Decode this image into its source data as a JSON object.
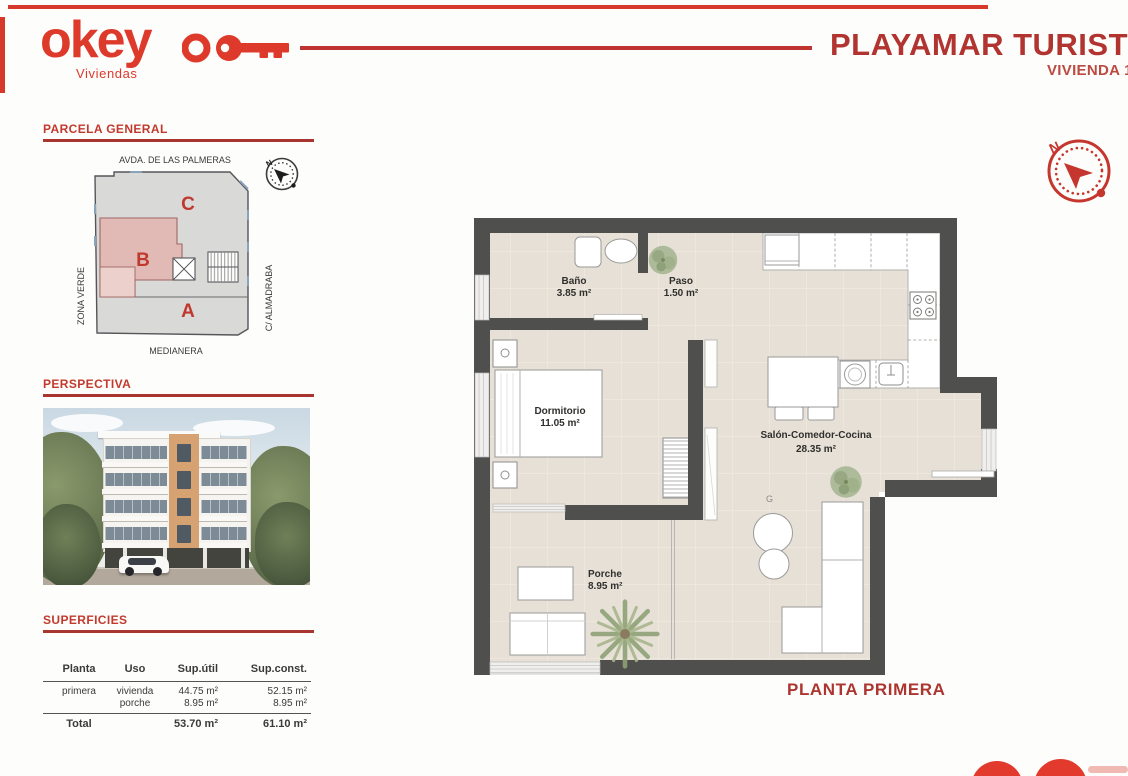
{
  "colors": {
    "accent_red": "#b5332f",
    "bright_red": "#dd3a2c",
    "heading_red": "#c23a2e",
    "wall_gray": "#4f4f4d",
    "floor_beige": "#e7e0d7",
    "block_pink": "#e2bab5",
    "plan_gray": "#d9d9d8"
  },
  "header": {
    "logo_text": "okey",
    "logo_tagline": "Viviendas",
    "title": "PLAYAMAR TURISTIC",
    "subtitle": "VIVIENDA 1ºB"
  },
  "parcela": {
    "heading": "PARCELA GENERAL",
    "street_top": "AVDA. DE LAS PALMERAS",
    "street_bottom": "MEDIANERA",
    "side_left": "ZONA VERDE",
    "side_right": "C/ ALMADRABA",
    "block_a": "A",
    "block_b": "B",
    "block_c": "C",
    "north": "N"
  },
  "perspectiva": {
    "heading": "PERSPECTIVA"
  },
  "superficies": {
    "heading": "SUPERFICIES",
    "columns": [
      "Planta",
      "Uso",
      "Sup.útil",
      "Sup.const."
    ],
    "row_planta": "primera",
    "row_uso1": "vivienda",
    "row_uso2": "porche",
    "row_util1": "44.75 m²",
    "row_util2": "8.95 m²",
    "row_const1": "52.15 m²",
    "row_const2": "8.95 m²",
    "total_label": "Total",
    "total_util": "53.70 m²",
    "total_const": "61.10 m²"
  },
  "floorplan": {
    "caption": "PLANTA PRIMERA",
    "north": "N",
    "mark": "G",
    "rooms": [
      {
        "name": "Baño",
        "area": "3.85 m²"
      },
      {
        "name": "Paso",
        "area": "1.50 m²"
      },
      {
        "name": "Dormitorio",
        "area": "11.05 m²"
      },
      {
        "name": "Salón-Comedor-Cocina",
        "area": "28.35 m²"
      },
      {
        "name": "Porche",
        "area": "8.95 m²"
      }
    ]
  }
}
